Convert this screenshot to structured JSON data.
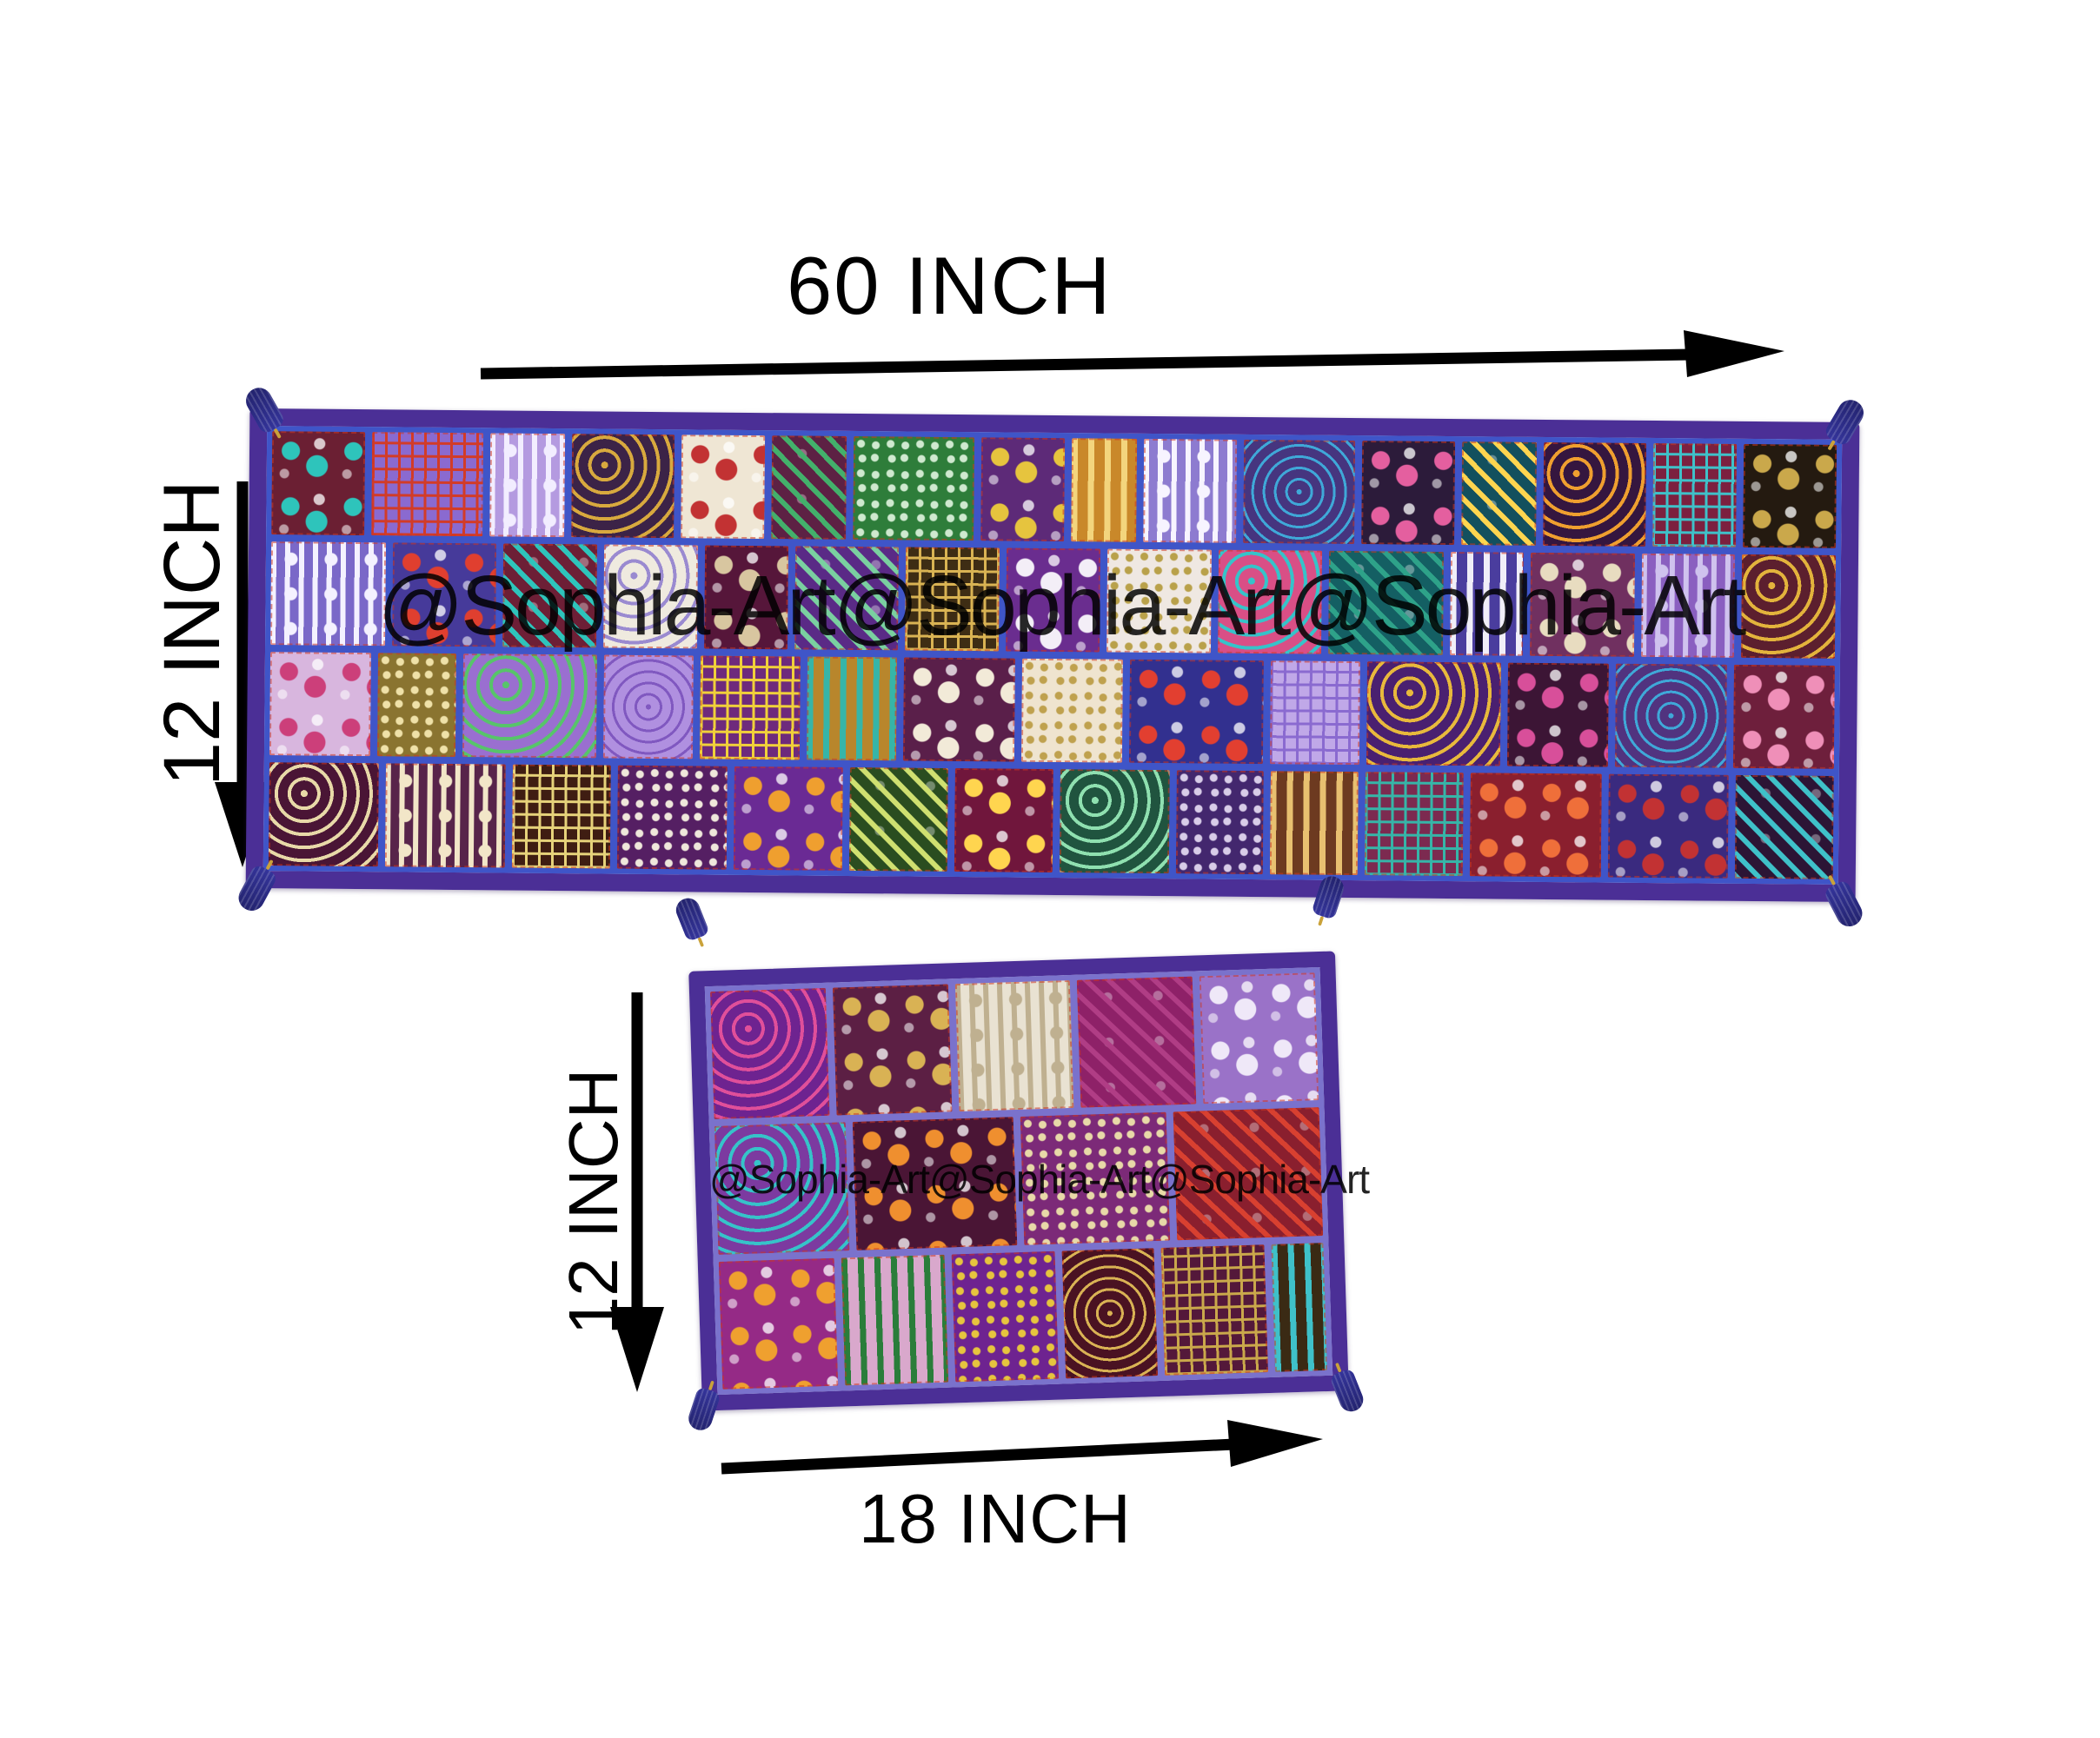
{
  "background": "#ffffff",
  "watermark": {
    "text": "@Sophia-Art@Sophia-Art@Sophia-Art",
    "color": "#000000"
  },
  "dimensions": {
    "top_width": "60 INCH",
    "top_height": "12 INCH",
    "bottom_height": "12 INCH",
    "bottom_width": "18 INCH"
  },
  "arrow_color": "#000000",
  "runner_large": {
    "description": "patchwork table runner 60 x 12 inch",
    "border_color": "#4b2f96",
    "seam_color": "#3f55c8",
    "stitch_color": "rgba(205,55,35,0.55)",
    "tassel_color": "#34349a",
    "tassel_band_color": "#caa23a",
    "rows": [
      [
        {
          "base": "#6b1f33",
          "accent": "#2ec4bb",
          "motif": "floral",
          "w": 1.0
        },
        {
          "base": "#8a6ad0",
          "accent": "#d23b28",
          "motif": "grid",
          "w": 1.2
        },
        {
          "base": "#b49ae0",
          "accent": "#f2edff",
          "motif": "lace",
          "w": 0.8
        },
        {
          "base": "#3c2347",
          "accent": "#d8a93e",
          "motif": "paisley",
          "w": 1.1
        },
        {
          "base": "#efe6d4",
          "accent": "#c23233",
          "motif": "floral",
          "w": 0.9
        },
        {
          "base": "#5d2144",
          "accent": "#43b06b",
          "motif": "leaf",
          "w": 0.8
        },
        {
          "base": "#2e7d3a",
          "accent": "#cfe9cf",
          "motif": "sequin",
          "w": 1.3
        },
        {
          "base": "#5d2a78",
          "accent": "#e6c43e",
          "motif": "floral",
          "w": 0.9
        },
        {
          "base": "#c9882a",
          "accent": "#f3d57d",
          "motif": "stripes",
          "w": 0.7
        },
        {
          "base": "#8d7bd0",
          "accent": "#f7f4ff",
          "motif": "lace",
          "w": 1.0
        },
        {
          "base": "#46357f",
          "accent": "#3fa8d8",
          "motif": "circles",
          "w": 1.2
        },
        {
          "base": "#2c1b3a",
          "accent": "#e45f9f",
          "motif": "floral",
          "w": 1.0
        },
        {
          "base": "#13505e",
          "accent": "#ffd54f",
          "motif": "leaf",
          "w": 0.8
        },
        {
          "base": "#35163f",
          "accent": "#ef9f2f",
          "motif": "paisley",
          "w": 1.1
        },
        {
          "base": "#7c203f",
          "accent": "#3fc1c9",
          "motif": "grid",
          "w": 0.9
        },
        {
          "base": "#241a10",
          "accent": "#caa84b",
          "motif": "floral",
          "w": 1.0
        }
      ],
      [
        {
          "base": "#7a68c8",
          "accent": "#f4f1ff",
          "motif": "lace",
          "w": 1.1
        },
        {
          "base": "#463a9a",
          "accent": "#e03f2f",
          "motif": "floral",
          "w": 1.0
        },
        {
          "base": "#6d1f36",
          "accent": "#2ec4bb",
          "motif": "leaf",
          "w": 0.9
        },
        {
          "base": "#efeadf",
          "accent": "#9a8ad0",
          "motif": "paisley",
          "w": 0.9
        },
        {
          "base": "#56163a",
          "accent": "#d8c6a0",
          "motif": "floral",
          "w": 0.8
        },
        {
          "base": "#5a2a86",
          "accent": "#7ad0a0",
          "motif": "leaf",
          "w": 1.0
        },
        {
          "base": "#3e2d14",
          "accent": "#d9b353",
          "motif": "grid",
          "w": 0.9
        },
        {
          "base": "#6a2d8f",
          "accent": "#f3eef7",
          "motif": "floral",
          "w": 0.9
        },
        {
          "base": "#efe8e2",
          "accent": "#b9a14a",
          "motif": "sequin",
          "w": 1.0
        },
        {
          "base": "#d94f86",
          "accent": "#36c3c9",
          "motif": "paisley",
          "w": 1.0
        },
        {
          "base": "#145f63",
          "accent": "#2ea289",
          "motif": "leaf",
          "w": 1.1
        },
        {
          "base": "#4a3d9e",
          "accent": "#f0eef8",
          "motif": "stripes",
          "w": 0.7
        },
        {
          "base": "#703060",
          "accent": "#e8dcc0",
          "motif": "floral",
          "w": 1.0
        },
        {
          "base": "#8a5fc0",
          "accent": "#cfc2ee",
          "motif": "lace",
          "w": 0.9
        },
        {
          "base": "#5c1f2e",
          "accent": "#e3b33c",
          "motif": "paisley",
          "w": 0.9
        }
      ],
      [
        {
          "base": "#d8b6de",
          "accent": "#cc3f7a",
          "motif": "floral",
          "w": 0.9
        },
        {
          "base": "#8a7430",
          "accent": "#efe1a8",
          "motif": "sequin",
          "w": 0.7
        },
        {
          "base": "#9a6fd0",
          "accent": "#57c46a",
          "motif": "paisley",
          "w": 1.2
        },
        {
          "base": "#b090e0",
          "accent": "#8058c0",
          "motif": "circles",
          "w": 0.8
        },
        {
          "base": "#6e2a7c",
          "accent": "#f0d03a",
          "motif": "grid",
          "w": 0.9
        },
        {
          "base": "#b8862c",
          "accent": "#36b5a8",
          "motif": "stripes",
          "w": 0.8
        },
        {
          "base": "#5a1f4a",
          "accent": "#f2ead8",
          "motif": "floral",
          "w": 1.0
        },
        {
          "base": "#efe4cf",
          "accent": "#bfa14e",
          "motif": "sequin",
          "w": 0.9
        },
        {
          "base": "#32308f",
          "accent": "#e23f30",
          "motif": "floral",
          "w": 1.2
        },
        {
          "base": "#c0a8e8",
          "accent": "#8a6ad0",
          "motif": "grid",
          "w": 0.8
        },
        {
          "base": "#4a2070",
          "accent": "#e8b93c",
          "motif": "paisley",
          "w": 1.2
        },
        {
          "base": "#3c1535",
          "accent": "#d84f9a",
          "motif": "floral",
          "w": 0.9
        },
        {
          "base": "#51337f",
          "accent": "#3fa8d8",
          "motif": "circles",
          "w": 1.0
        },
        {
          "base": "#6e1f3c",
          "accent": "#ef8fb8",
          "motif": "floral",
          "w": 0.9
        }
      ],
      [
        {
          "base": "#4a1535",
          "accent": "#e8d9a8",
          "motif": "paisley",
          "w": 1.0
        },
        {
          "base": "#58244a",
          "accent": "#f2e6c8",
          "motif": "lace",
          "w": 1.1
        },
        {
          "base": "#3f1d12",
          "accent": "#e6d27a",
          "motif": "grid",
          "w": 0.9
        },
        {
          "base": "#551f63",
          "accent": "#efe7db",
          "motif": "sequin",
          "w": 1.0
        },
        {
          "base": "#6a2a94",
          "accent": "#ef9f2f",
          "motif": "floral",
          "w": 1.0
        },
        {
          "base": "#2a4d20",
          "accent": "#cfe070",
          "motif": "leaf",
          "w": 0.9
        },
        {
          "base": "#70163c",
          "accent": "#ffd54f",
          "motif": "floral",
          "w": 0.9
        },
        {
          "base": "#20543f",
          "accent": "#8fe0b0",
          "motif": "paisley",
          "w": 1.0
        },
        {
          "base": "#43276e",
          "accent": "#d8cce8",
          "motif": "sequin",
          "w": 0.8
        },
        {
          "base": "#6d3a20",
          "accent": "#e8c070",
          "motif": "stripes",
          "w": 0.8
        },
        {
          "base": "#7c2a50",
          "accent": "#36b5a8",
          "motif": "grid",
          "w": 0.9
        },
        {
          "base": "#8a1f2e",
          "accent": "#ef6f3a",
          "motif": "floral",
          "w": 1.2
        },
        {
          "base": "#3a2a7f",
          "accent": "#c23233",
          "motif": "floral",
          "w": 1.1
        },
        {
          "base": "#2c1535",
          "accent": "#3fc1c9",
          "motif": "leaf",
          "w": 0.9
        }
      ]
    ]
  },
  "runner_small": {
    "description": "patchwork table mat 18 x 12 inch",
    "border_color": "#4b2f96",
    "seam_color": "#7a72cc",
    "stitch_color": "rgba(205,55,35,0.55)",
    "tassel_color": "#34349a",
    "tassel_band_color": "#caa23a",
    "rows": [
      [
        {
          "base": "#6e2390",
          "accent": "#e04f9a",
          "motif": "paisley",
          "w": 1.0
        },
        {
          "base": "#5c1f44",
          "accent": "#d9b254",
          "motif": "floral",
          "w": 1.0
        },
        {
          "base": "#e9e2d2",
          "accent": "#bfb090",
          "motif": "lace",
          "w": 1.0
        },
        {
          "base": "#8e2168",
          "accent": "#b03d85",
          "motif": "leaf",
          "w": 1.0
        },
        {
          "base": "#9a72c8",
          "accent": "#efe8f8",
          "motif": "floral",
          "w": 1.0
        }
      ],
      [
        {
          "base": "#7c3aa0",
          "accent": "#36c3c9",
          "motif": "paisley",
          "w": 0.9
        },
        {
          "base": "#4a1535",
          "accent": "#ef8f2f",
          "motif": "floral",
          "w": 1.1
        },
        {
          "base": "#7c2a78",
          "accent": "#e8d9a8",
          "motif": "sequin",
          "w": 1.0
        },
        {
          "base": "#8a1f2e",
          "accent": "#d84030",
          "motif": "leaf",
          "w": 1.0
        }
      ],
      [
        {
          "base": "#952a86",
          "accent": "#efa02f",
          "motif": "floral",
          "w": 1.0
        },
        {
          "base": "#d9a8cc",
          "accent": "#2a7d3a",
          "motif": "stripes",
          "w": 0.9
        },
        {
          "base": "#6e2390",
          "accent": "#e6c43e",
          "motif": "sequin",
          "w": 0.9
        },
        {
          "base": "#4a1222",
          "accent": "#d9b254",
          "motif": "circles",
          "w": 0.8
        },
        {
          "base": "#54183a",
          "accent": "#caa84b",
          "motif": "grid",
          "w": 0.9
        },
        {
          "base": "#3a2a14",
          "accent": "#3fc1c9",
          "motif": "stripes",
          "w": 0.45
        }
      ]
    ]
  }
}
